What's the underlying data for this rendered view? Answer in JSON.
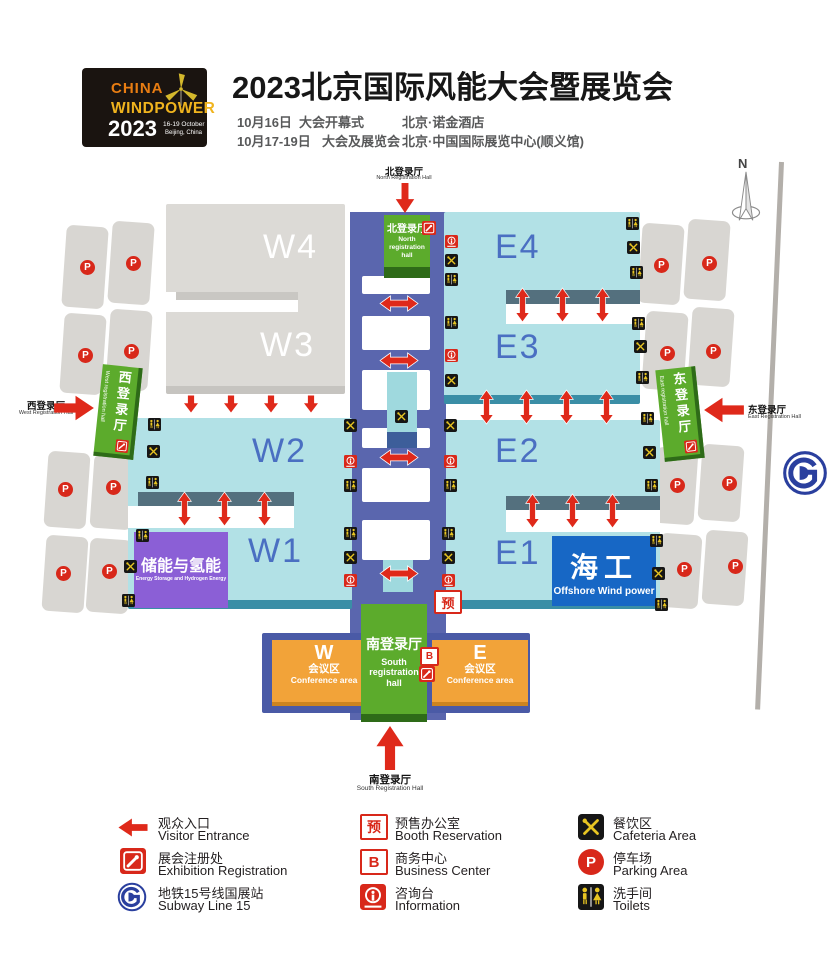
{
  "logo": {
    "brand1": "CHINA",
    "brand2": "WINDPOWER",
    "year": "2023",
    "dates": "16-19 October",
    "city": "Beijing, China"
  },
  "header": {
    "title": "2023北京国际风能大会暨展览会",
    "schedule": [
      {
        "date": "10月16日",
        "event": "大会开幕式",
        "venue": "北京·诺金酒店"
      },
      {
        "date": "10月17-19日",
        "event": "大会及展览会",
        "venue": "北京·中国国际展览中心(顺义馆)"
      }
    ]
  },
  "map": {
    "compass": "N",
    "halls": {
      "w4": "W4",
      "w3": "W3",
      "w2": "W2",
      "w1": "W1",
      "e4": "E4",
      "e3": "E3",
      "e2": "E2",
      "e1": "E1"
    },
    "entrances": {
      "north": {
        "cn": "北登录厅",
        "en": "North Registration Hall"
      },
      "south": {
        "cn": "南登录厅",
        "en": "South Registration Hall"
      },
      "west": {
        "cn": "西登录厅",
        "en": "West Registration Hall"
      },
      "east": {
        "cn": "东登录厅",
        "en": "East Registration Hall"
      }
    },
    "reg_halls": {
      "north": {
        "cn": "北登录厅",
        "en": "North registration hall"
      },
      "south": {
        "cn": "南登录厅",
        "en": "South registration hall"
      },
      "west": {
        "cn": "西登录厅",
        "en": "West registration hall"
      },
      "east": {
        "cn": "东登录厅",
        "en": "East registration hall"
      }
    },
    "zones": {
      "storage": {
        "cn": "储能与氢能",
        "en": "Energy Storage and Hydrogen Energy"
      },
      "offshore": {
        "cn": "海工",
        "en": "Offshore Wind power"
      }
    },
    "conference": {
      "w": "W",
      "e": "E",
      "cn": "会议区",
      "en": "Conference area"
    }
  },
  "badges": {
    "parking": "P",
    "booth": "预",
    "business": "B"
  },
  "legend": [
    {
      "cn": "观众入口",
      "en": "Visitor Entrance"
    },
    {
      "cn": "展会注册处",
      "en": "Exhibition Registration"
    },
    {
      "cn": "地铁15号线国展站",
      "en": "Subway Line 15"
    },
    {
      "cn": "预售办公室",
      "en": "Booth Reservation"
    },
    {
      "cn": "商务中心",
      "en": "Business Center"
    },
    {
      "cn": "咨询台",
      "en": "Information"
    },
    {
      "cn": "餐饮区",
      "en": "Cafeteria Area"
    },
    {
      "cn": "停车场",
      "en": "Parking Area"
    },
    {
      "cn": "洗手间",
      "en": "Toilets"
    }
  ],
  "colors": {
    "red": "#df291a",
    "green": "#5cab2c",
    "cyan": "#b2e1e6",
    "corridor": "#5a66ae",
    "orange": "#f2a339",
    "purple": "#8b5fd6",
    "offshore_blue": "#1767c5",
    "subway_blue": "#2a3f9e"
  }
}
